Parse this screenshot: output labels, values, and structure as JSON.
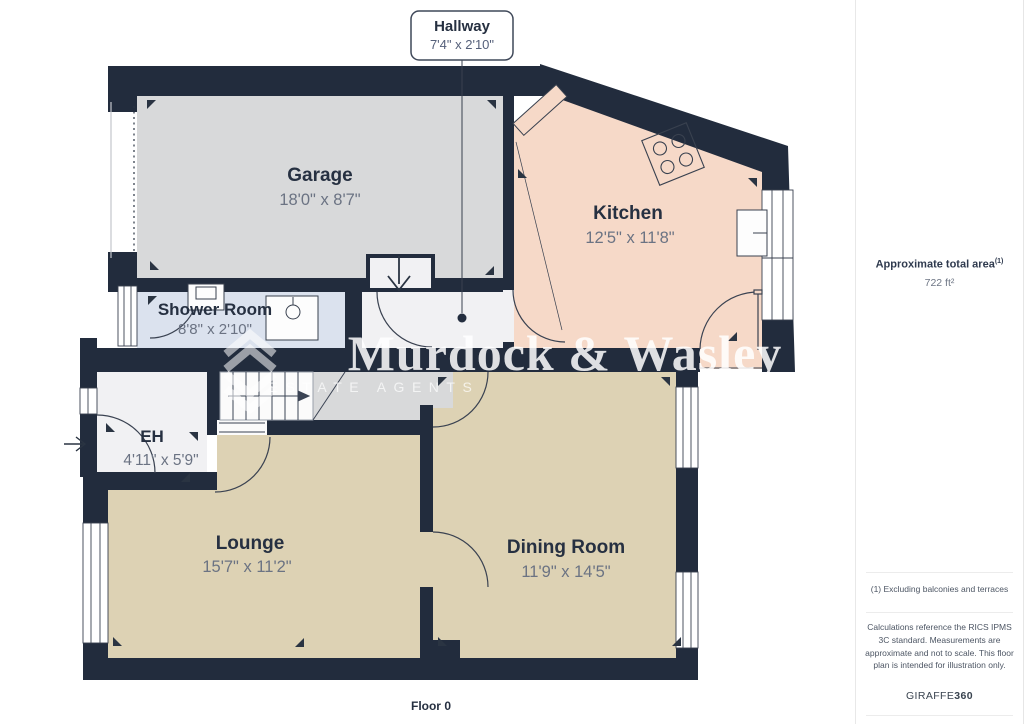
{
  "plan": {
    "floor_label": "Floor 0",
    "callout": {
      "room": "Hallway",
      "dims": "7'4\" x 2'10\""
    },
    "rooms": [
      {
        "name": "Garage",
        "dims": "18'0\" x 8'7\""
      },
      {
        "name": "Kitchen",
        "dims": "12'5\" x 11'8\""
      },
      {
        "name": "Shower Room",
        "dims": "8'8\" x 2'10\""
      },
      {
        "name": "EH",
        "dims": "4'11\" x 5'9\""
      },
      {
        "name": "Lounge",
        "dims": "15'7\" x 11'2\""
      },
      {
        "name": "Dining Room",
        "dims": "11'9\" x 14'5\""
      }
    ],
    "colors": {
      "wall": "#222c3d",
      "garage_floor": "#d8d9da",
      "kitchen_floor": "#f6d9c8",
      "shower_floor": "#dbe2ee",
      "living_floor": "#ddd2b4",
      "hall_floor": "#f1f1f3"
    }
  },
  "watermark": {
    "brand": "Murdock & Wasley",
    "tagline": "ESTATE AGENTS"
  },
  "sidebar": {
    "area_label": "Approximate total area",
    "area_ref": "(1)",
    "area_value": "722 ft²",
    "footnote": "(1) Excluding balconies and terraces",
    "disclaimer": "Calculations reference the RICS IPMS 3C standard. Measurements are approximate and not to scale. This floor plan is intended for illustration only.",
    "brand": "GIRAFFE",
    "brand_suffix": "360"
  }
}
